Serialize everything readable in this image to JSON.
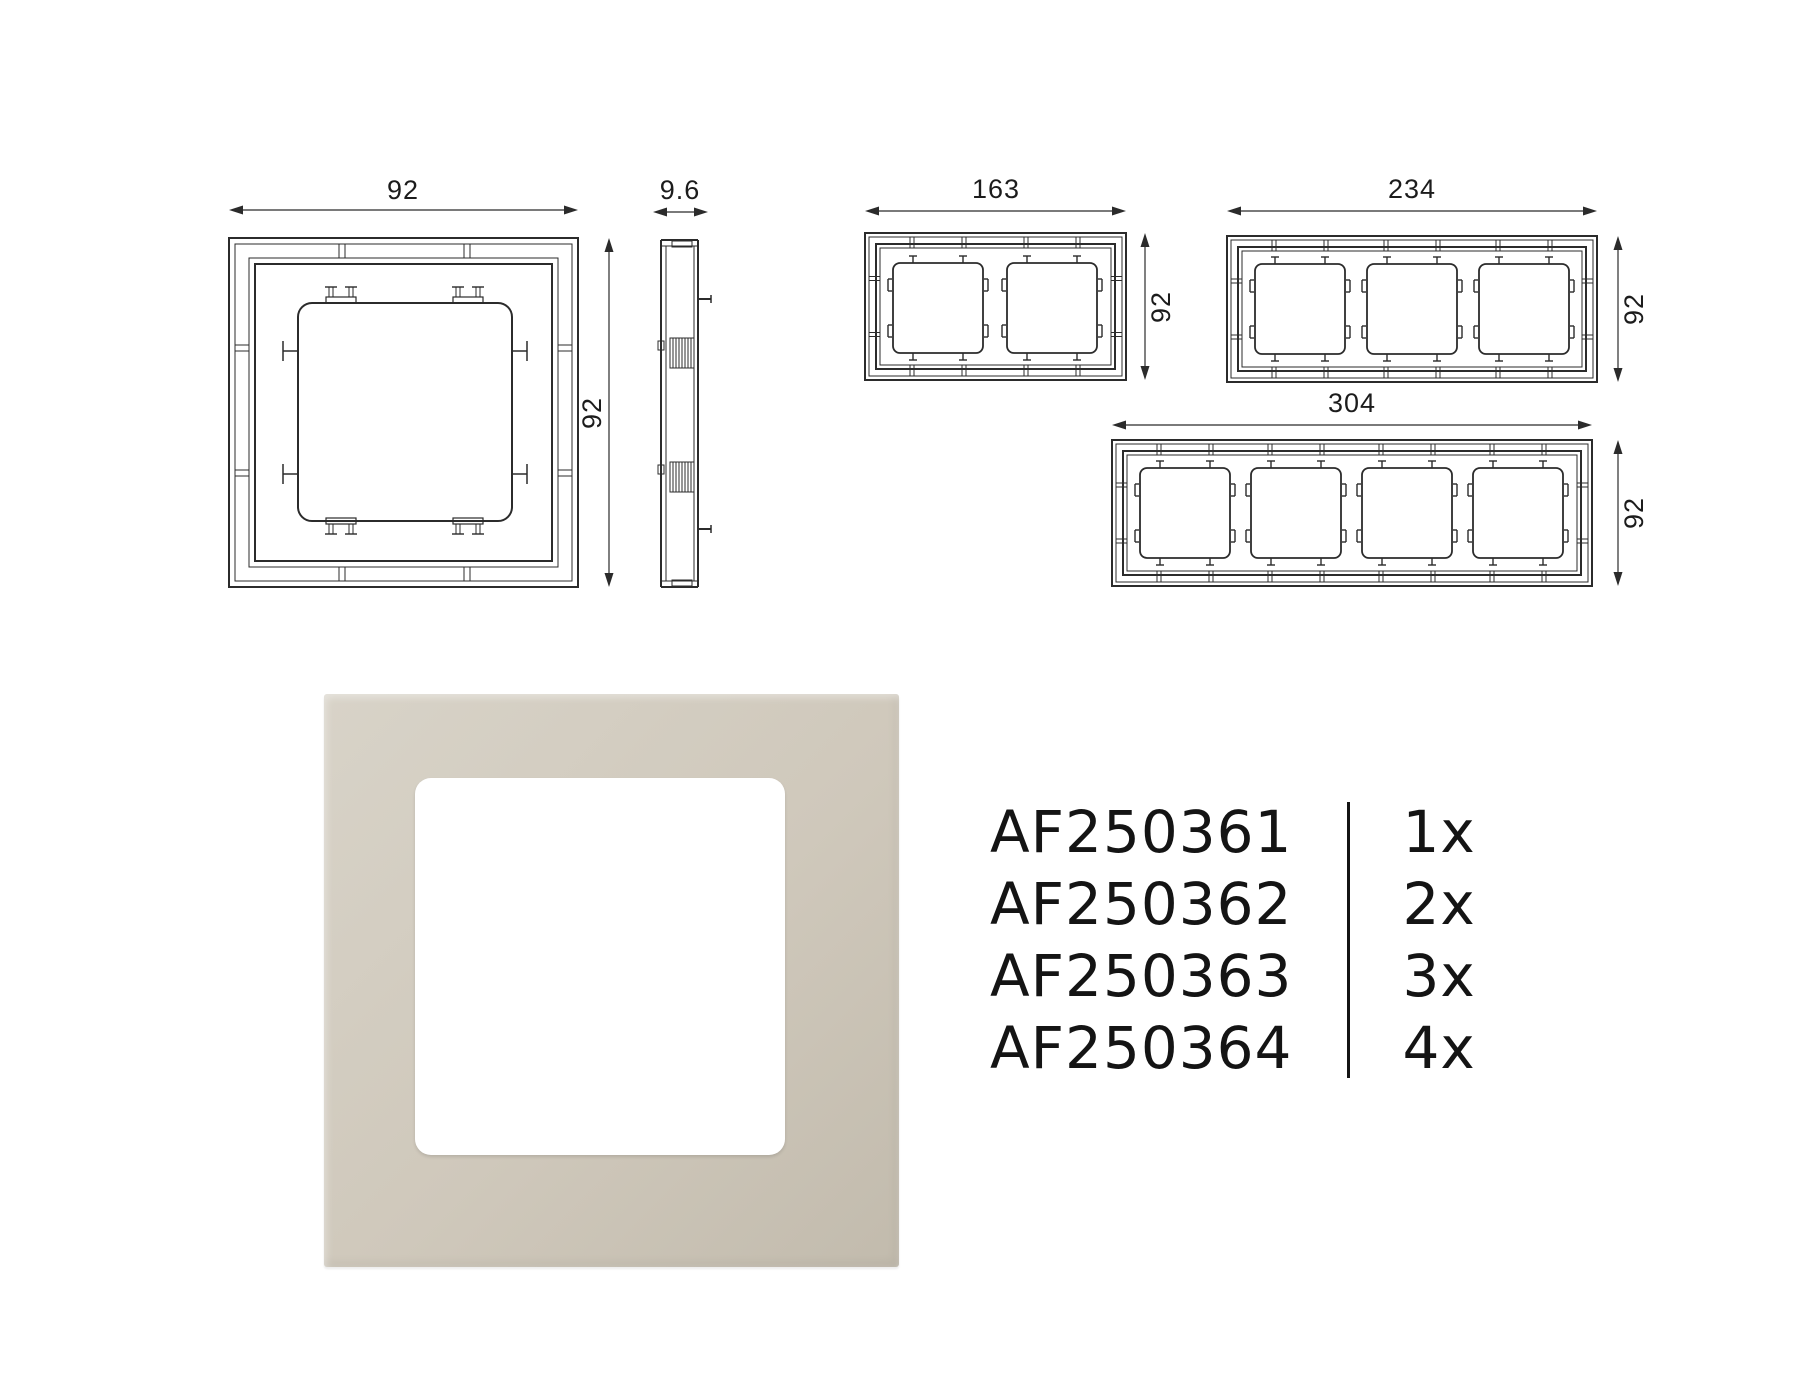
{
  "colors": {
    "line": "#2b2b2b",
    "text": "#1c1c1c",
    "frame_light": "#d8d3c8",
    "frame_mid": "#cfc8bb",
    "frame_dark": "#c2bbad",
    "window": "#ffffff"
  },
  "drawings": {
    "views": [
      {
        "name": "front-view-1-gang",
        "width_label": "92",
        "height_label": "92"
      },
      {
        "name": "side-view",
        "depth_label": "9.6"
      },
      {
        "name": "front-view-2-gang",
        "width_label": "163",
        "height_label": "92"
      },
      {
        "name": "front-view-3-gang",
        "width_label": "234",
        "height_label": "92"
      },
      {
        "name": "front-view-4-gang",
        "width_label": "304",
        "height_label": "92"
      }
    ]
  },
  "parts_list": {
    "rows": [
      {
        "code": "AF250361",
        "qty": "1x"
      },
      {
        "code": "AF250362",
        "qty": "2x"
      },
      {
        "code": "AF250363",
        "qty": "3x"
      },
      {
        "code": "AF250364",
        "qty": "4x"
      }
    ]
  }
}
